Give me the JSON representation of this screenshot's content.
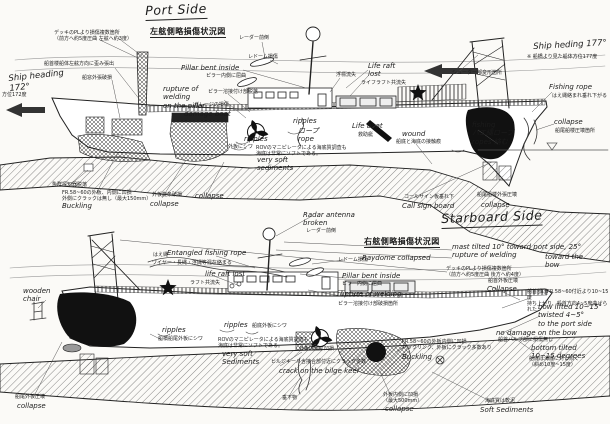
{
  "colors": {
    "ink": "#1c1c1c",
    "paper": "#fbfaf7",
    "hatch": "#444",
    "damage_fill": "#111"
  },
  "annotations": [
    {
      "n": "port-title",
      "t": "Port Side",
      "x": 145,
      "y": 4,
      "s": "t",
      "u": true,
      "r": -2
    },
    {
      "n": "port-jp-title",
      "t": "左舷側略損傷状況図",
      "x": 150,
      "y": 27,
      "s": "jt",
      "u": true
    },
    {
      "n": "deck-pl-note",
      "t": "デッキのPLより損傷複数箇所\n（前方へ約5度圧曲 左舷へ約3度）",
      "x": 54,
      "y": 31,
      "s": "j"
    },
    {
      "n": "heading-172",
      "t": "Ship heading\n172°",
      "x": 8,
      "y": 74,
      "s": "e8",
      "r": -6
    },
    {
      "n": "heading-172-jp",
      "t": "方位172度",
      "x": 2,
      "y": 93,
      "s": "j"
    },
    {
      "n": "bow-overhang-note",
      "t": "船首楼船体左舷方向に歪み張出",
      "x": 44,
      "y": 62,
      "s": "j"
    },
    {
      "n": "window-plate-note",
      "t": "船窓外張破損",
      "x": 82,
      "y": 76,
      "s": "j"
    },
    {
      "n": "radar-forward-top",
      "t": "レーダー前倒",
      "x": 239,
      "y": 36,
      "s": "j"
    },
    {
      "n": "radome-damage-top",
      "t": "レドーム損傷",
      "x": 248,
      "y": 55,
      "s": "j"
    },
    {
      "n": "pillar-bent-en",
      "t": "Pillar bent inside",
      "x": 181,
      "y": 64,
      "s": "e"
    },
    {
      "n": "pillar-bent-jp",
      "t": "ピラー内側に屈曲",
      "x": 206,
      "y": 74,
      "s": "j"
    },
    {
      "n": "rupture-welding-en",
      "t": "rupture of\nwelding\non the pillar",
      "x": 163,
      "y": 85,
      "s": "e"
    },
    {
      "n": "rupture-welding-jp",
      "t": "ピラー溶接付け部脱落",
      "x": 208,
      "y": 90,
      "s": "j"
    },
    {
      "n": "garage-damage-jp",
      "t": "ガレージの損傷",
      "x": 194,
      "y": 103,
      "s": "j"
    },
    {
      "n": "garage-damage-en",
      "t": "damage boat",
      "x": 184,
      "y": 110,
      "s": "e"
    },
    {
      "n": "ripples-1",
      "t": "ripples",
      "x": 244,
      "y": 135,
      "s": "e"
    },
    {
      "n": "hull-wrinkle-1",
      "t": "外板にシワ",
      "x": 228,
      "y": 145,
      "s": "j"
    },
    {
      "n": "ripples-2",
      "t": "ripples",
      "x": 293,
      "y": 117,
      "s": "e"
    },
    {
      "n": "rope-label",
      "t": "ロープ\nrope",
      "x": 298,
      "y": 127,
      "s": "e"
    },
    {
      "n": "fishfinder-note",
      "t": "魚群探知器脱落",
      "x": 52,
      "y": 183,
      "s": "j"
    },
    {
      "n": "fr58-note",
      "t": "FR.58~60の外板、内側に凹損\n外側にクラックは無し（最大150mm）",
      "x": 62,
      "y": 191,
      "s": "j"
    },
    {
      "n": "buckling-1",
      "t": "Buckling",
      "x": 62,
      "y": 202,
      "s": "e"
    },
    {
      "n": "shell-collapse-jp",
      "t": "外板旋条破損",
      "x": 152,
      "y": 193,
      "s": "j"
    },
    {
      "n": "shell-collapse-en",
      "t": "collapse",
      "x": 150,
      "y": 200,
      "s": "e"
    },
    {
      "n": "collapse-2",
      "t": "collapse",
      "x": 195,
      "y": 192,
      "s": "e"
    },
    {
      "n": "rov-note-1",
      "t": "ROVのマニピレータによる海底質調査も\n海底は非常にソフトである。",
      "x": 256,
      "y": 146,
      "s": "j"
    },
    {
      "n": "very-soft-1",
      "t": "very soft\nsediments",
      "x": 257,
      "y": 156,
      "s": "e"
    },
    {
      "n": "buoy-lost",
      "t": "浮標流失",
      "x": 336,
      "y": 73,
      "s": "j"
    },
    {
      "n": "liferaft-lost-en",
      "t": "Life raft\nlost",
      "x": 368,
      "y": 62,
      "s": "e"
    },
    {
      "n": "liferaft-lost-jp",
      "t": "ライフラフト共流失",
      "x": 361,
      "y": 81,
      "s": "j"
    },
    {
      "n": "chute-note",
      "t": "シューター部変形箇所",
      "x": 452,
      "y": 71,
      "s": "j"
    },
    {
      "n": "heading-177",
      "t": "Ship heding 177°",
      "x": 533,
      "y": 42,
      "s": "e8",
      "r": -3
    },
    {
      "n": "heading-177-jp",
      "t": "※ 船橋より見た船体方位177度",
      "x": 527,
      "y": 55,
      "s": "j"
    },
    {
      "n": "fishing-rope-en",
      "t": "Fishing rope",
      "x": 549,
      "y": 83,
      "s": "e"
    },
    {
      "n": "fishing-rope-jp",
      "t": "はえ縄絡まれ垂れ下がる",
      "x": 552,
      "y": 94,
      "s": "j"
    },
    {
      "n": "collapse-stern-en",
      "t": "collapse",
      "x": 554,
      "y": 118,
      "s": "e"
    },
    {
      "n": "collapse-stern-jp",
      "t": "船尾船楼圧壊箇所",
      "x": 555,
      "y": 129,
      "s": "j"
    },
    {
      "n": "fishing-ropes-mid",
      "t": "fishing\nハエ縄ロープ\nropes 絡む",
      "x": 472,
      "y": 121,
      "s": "e"
    },
    {
      "n": "lifeboat-en",
      "t": "Life boat",
      "x": 352,
      "y": 122,
      "s": "e"
    },
    {
      "n": "lifeboat-jp",
      "t": "救助艇",
      "x": 358,
      "y": 133,
      "s": "j"
    },
    {
      "n": "wound-en",
      "t": "wound",
      "x": 402,
      "y": 130,
      "s": "e"
    },
    {
      "n": "wound-jp",
      "t": "船底と海底の接触痕",
      "x": 396,
      "y": 140,
      "s": "j"
    },
    {
      "n": "callsign-jp",
      "t": "コールサイン板垂れ下",
      "x": 404,
      "y": 195,
      "s": "j"
    },
    {
      "n": "callsign-en",
      "t": "Call sign board",
      "x": 402,
      "y": 202,
      "s": "e"
    },
    {
      "n": "stern-shell-jp",
      "t": "船尾船楼外張圧壊",
      "x": 477,
      "y": 193,
      "s": "j"
    },
    {
      "n": "stern-shell-en",
      "t": "collapse",
      "x": 481,
      "y": 201,
      "s": "e"
    },
    {
      "n": "radar-broken-en",
      "t": "Radar antenna\nbroken",
      "x": 303,
      "y": 211,
      "s": "e"
    },
    {
      "n": "radar-broken-jp",
      "t": "レーダー前倒",
      "x": 306,
      "y": 229,
      "s": "j"
    },
    {
      "n": "starboard-title",
      "t": "Starboard Side",
      "x": 441,
      "y": 212,
      "s": "t",
      "u": true,
      "r": -2
    },
    {
      "n": "starboard-jp-title",
      "t": "右舷側略損傷状況図",
      "x": 364,
      "y": 237,
      "s": "jt",
      "u": true
    },
    {
      "n": "mast-tilted-note",
      "t": "mast tilted 10° toward port side, 25°\nrupture of welding",
      "x": 452,
      "y": 243,
      "s": "e"
    },
    {
      "n": "toward-bow-note",
      "t": "toward the\nbow",
      "x": 545,
      "y": 253,
      "s": "e"
    },
    {
      "n": "deck-pl-note-2",
      "t": "デッキのPLより損傷複数箇所\n（前方へ約5度圧曲 後方へ約4度）",
      "x": 446,
      "y": 267,
      "s": "j"
    },
    {
      "n": "bow-collapse-jp",
      "t": "船首外板圧壊",
      "x": 488,
      "y": 279,
      "s": "j"
    },
    {
      "n": "bow-collapse-en",
      "t": "Collapse",
      "x": 487,
      "y": 285,
      "s": "e"
    },
    {
      "n": "bow-lifted-jp",
      "t": "船首部はFR.58~60付近より10~15度\n持ち上がり、船首方向4~5度曲げられた",
      "x": 527,
      "y": 290,
      "s": "j"
    },
    {
      "n": "bow-lifted-en",
      "t": "bow lifted 10~15°\ntwisted 4~5°\nto the port side",
      "x": 538,
      "y": 303,
      "s": "e"
    },
    {
      "n": "no-damage-bow-en",
      "t": "no damage on the bow",
      "x": 496,
      "y": 329,
      "s": "e"
    },
    {
      "n": "no-damage-bow-jp",
      "t": "船首バルブ部に損傷無し",
      "x": 498,
      "y": 338,
      "s": "j"
    },
    {
      "n": "bottom-tilted-en",
      "t": "bottom tilted\n10~15 degrees",
      "x": 531,
      "y": 344,
      "s": "e"
    },
    {
      "n": "bottom-tilted-jp",
      "t": "船底は海底に対し傾く\n（斜め10度~15度）",
      "x": 529,
      "y": 357,
      "s": "j"
    },
    {
      "n": "soft-sediments-jp",
      "t": "海底質は軟泥",
      "x": 485,
      "y": 399,
      "s": "j"
    },
    {
      "n": "soft-sediments-en",
      "t": "Soft Sediments",
      "x": 480,
      "y": 406,
      "s": "e"
    },
    {
      "n": "entangled-en",
      "t": "Entangled fishing rope",
      "x": 167,
      "y": 249,
      "s": "e"
    },
    {
      "n": "entangled-jp1",
      "t": "はえ縄",
      "x": 153,
      "y": 253,
      "s": "j"
    },
    {
      "n": "entangled-jp2",
      "t": "ワイヤー・長縄・浮縄等混在絡まる",
      "x": 152,
      "y": 261,
      "s": "j"
    },
    {
      "n": "liferaft-lost-2-en",
      "t": "life raft lost",
      "x": 205,
      "y": 270,
      "s": "e"
    },
    {
      "n": "liferaft-lost-2-jp",
      "t": "ラフト共流失",
      "x": 190,
      "y": 281,
      "s": "j"
    },
    {
      "n": "raydome-2-jp",
      "t": "レドーム損傷",
      "x": 338,
      "y": 258,
      "s": "j"
    },
    {
      "n": "raydome-2-en",
      "t": "Raydome collapsed",
      "x": 362,
      "y": 254,
      "s": "e"
    },
    {
      "n": "pillar-bent-2-en",
      "t": "Pillar bent inside",
      "x": 342,
      "y": 272,
      "s": "e"
    },
    {
      "n": "pillar-bent-2-jp",
      "t": "ピラー内側に屈曲",
      "x": 342,
      "y": 282,
      "s": "j"
    },
    {
      "n": "rupture-welding-2-en",
      "t": "rupture of welding",
      "x": 337,
      "y": 290,
      "s": "e"
    },
    {
      "n": "rupture-welding-2-jp",
      "t": "ピラー溶接付け部破損箇所",
      "x": 338,
      "y": 302,
      "s": "j"
    },
    {
      "n": "wooden-chair",
      "t": "wooden\nchair",
      "x": 23,
      "y": 287,
      "s": "e"
    },
    {
      "n": "ripples-3",
      "t": "ripples",
      "x": 162,
      "y": 326,
      "s": "e"
    },
    {
      "n": "ripples-4",
      "t": "ripples",
      "x": 224,
      "y": 321,
      "s": "e"
    },
    {
      "n": "hull-wrinkle-2",
      "t": "船底外板にシワ",
      "x": 252,
      "y": 324,
      "s": "j"
    },
    {
      "n": "rov-note-2",
      "t": "ROVのマニピレータによる海底質調査も\n海底は非常にソフトである。",
      "x": 218,
      "y": 338,
      "s": "j"
    },
    {
      "n": "very-soft-2",
      "t": "very soft\nSediments",
      "x": 222,
      "y": 350,
      "s": "e"
    },
    {
      "n": "hanging-object-jp",
      "t": "垂下物",
      "x": 282,
      "y": 396,
      "s": "j"
    },
    {
      "n": "bilge-keel-jp",
      "t": "ビルジキール含接合部付近にクラック多数",
      "x": 271,
      "y": 360,
      "s": "j"
    },
    {
      "n": "bilge-keel-en",
      "t": "crack on the bilge keel",
      "x": 279,
      "y": 367,
      "s": "e"
    },
    {
      "n": "dent-plate-jp",
      "t": "外板内側に凹損",
      "x": 299,
      "y": 347,
      "s": "j"
    },
    {
      "n": "collapse-3-jp",
      "t": "外板内側に凹損\n（最大500mm）",
      "x": 383,
      "y": 393,
      "s": "j"
    },
    {
      "n": "collapse-3-en",
      "t": "collapse",
      "x": 385,
      "y": 405,
      "s": "e"
    },
    {
      "n": "fr58-note-2",
      "t": "FR.58~60の外板内側に凹損\nバックリング、外板にクラック多数あり",
      "x": 402,
      "y": 340,
      "s": "j"
    },
    {
      "n": "buckling-2",
      "t": "Buckling",
      "x": 402,
      "y": 353,
      "s": "e"
    },
    {
      "n": "stern-collapse-2-jp",
      "t": "船尾外板圧壊",
      "x": 15,
      "y": 395,
      "s": "j"
    },
    {
      "n": "stern-collapse-2-en",
      "t": "collapse",
      "x": 17,
      "y": 402,
      "s": "e"
    },
    {
      "n": "bridge-wrinkle-jp",
      "t": "船橋船尾外板にシワ",
      "x": 158,
      "y": 337,
      "s": "j"
    }
  ]
}
